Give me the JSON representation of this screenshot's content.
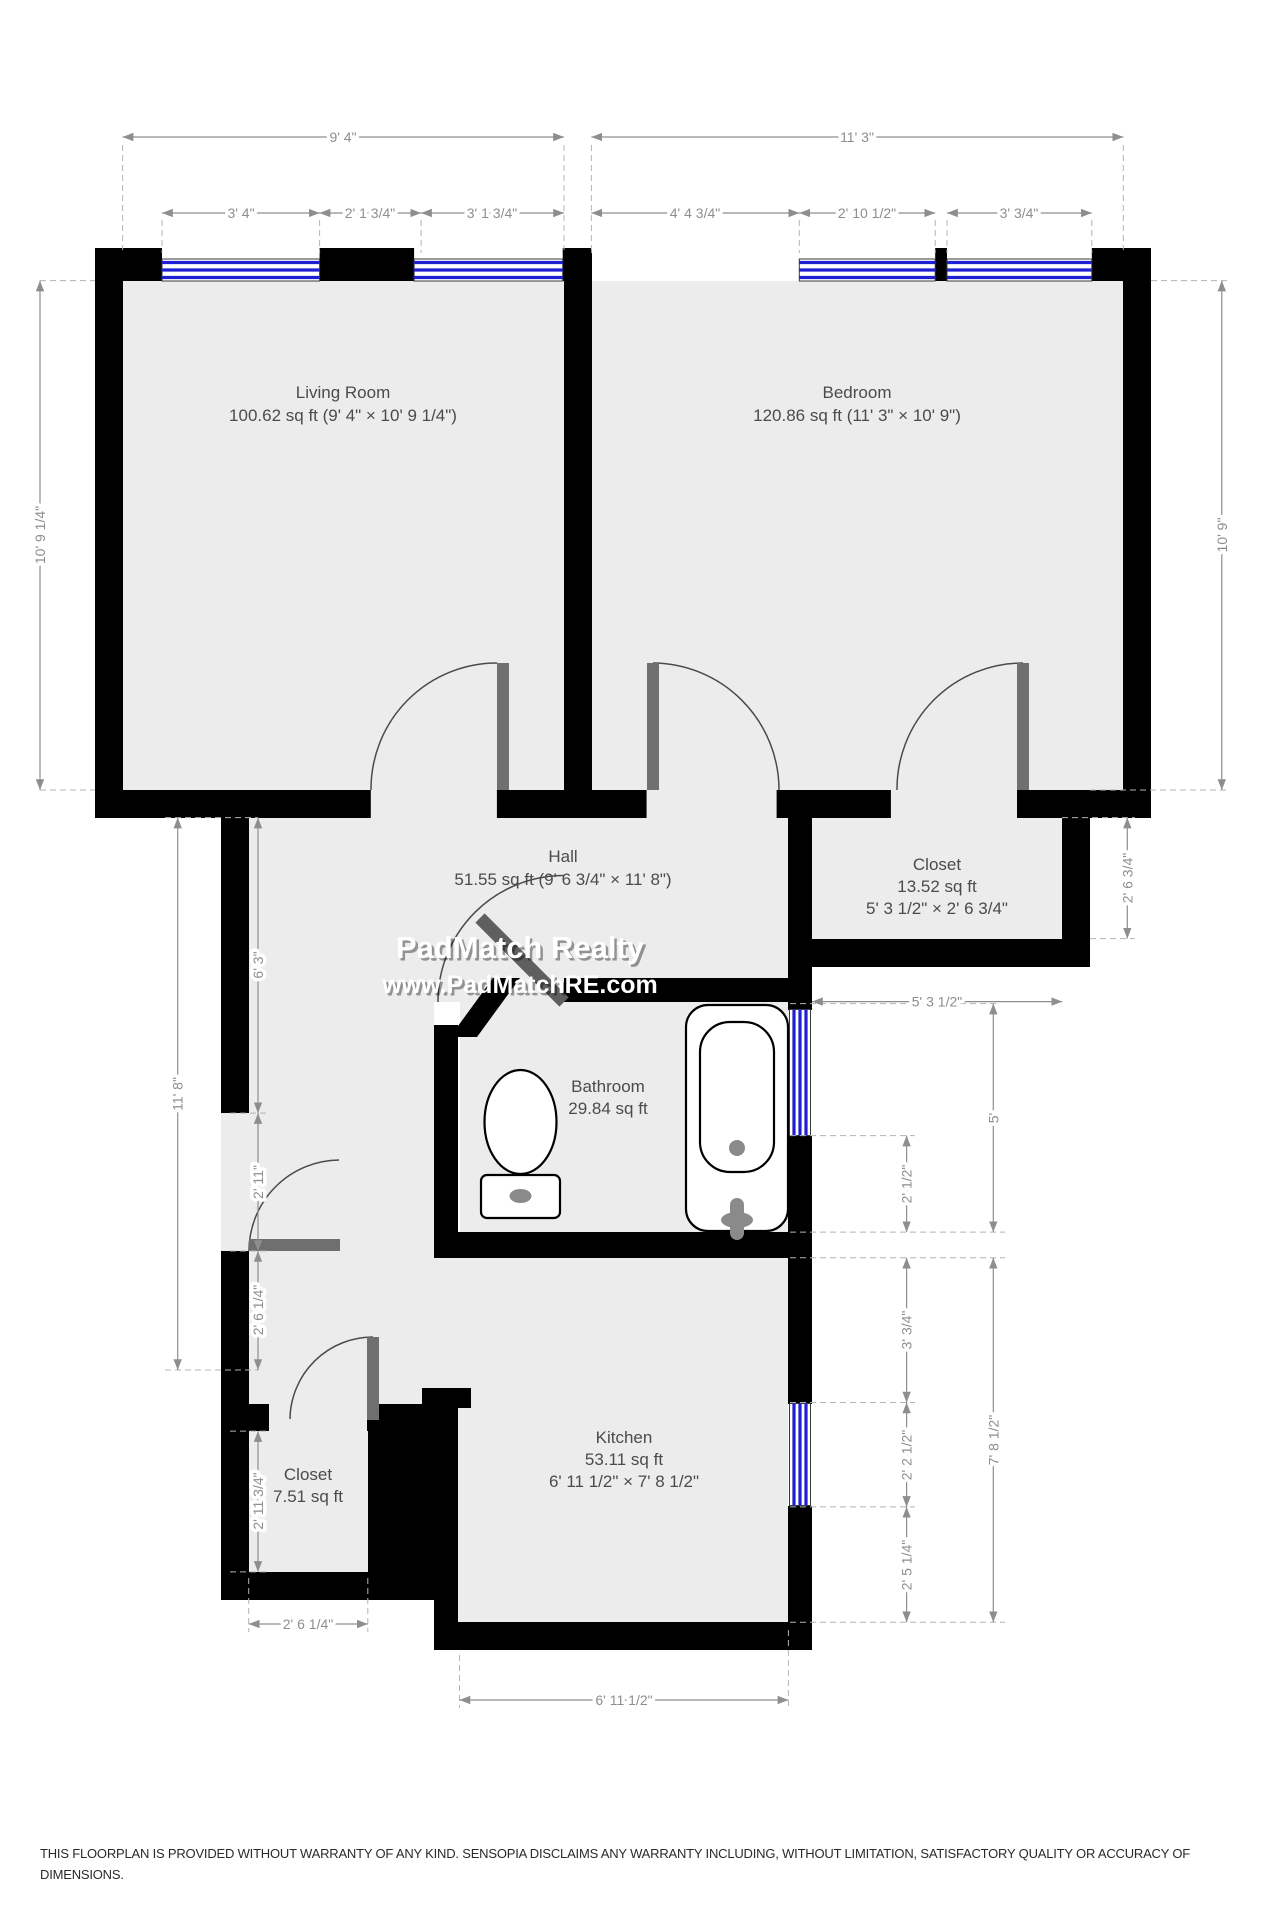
{
  "watermark": {
    "line1": "PadMatch Realty",
    "line2": "www.PadMatchRE.com"
  },
  "disclaimer": {
    "line1": "THIS FLOORPLAN IS PROVIDED WITHOUT WARRANTY OF ANY KIND. SENSOPIA DISCLAIMS ANY WARRANTY INCLUDING, WITHOUT LIMITATION, SATISFACTORY QUALITY OR ACCURACY OF",
    "line2": "DIMENSIONS."
  },
  "rooms": {
    "living": {
      "name": "Living Room",
      "area": "100.62 sq ft (9' 4\" × 10' 9 1/4\")"
    },
    "bedroom": {
      "name": "Bedroom",
      "area": "120.86 sq ft (11' 3\" × 10' 9\")"
    },
    "hall": {
      "name": "Hall",
      "area": "51.55 sq ft (9' 6 3/4\" × 11' 8\")"
    },
    "closet_top": {
      "name": "Closet",
      "area": "13.52 sq ft",
      "dims": "5' 3 1/2\" × 2' 6 3/4\""
    },
    "bathroom": {
      "name": "Bathroom",
      "area": "29.84 sq ft"
    },
    "kitchen": {
      "name": "Kitchen",
      "area": "53.11 sq ft",
      "dims": "6' 11 1/2\" × 7' 8 1/2\""
    },
    "closet_bottom": {
      "name": "Closet",
      "area": "7.51 sq ft"
    }
  },
  "dimensions": {
    "top_living_total": "9' 4\"",
    "top_living_1": "3' 4\"",
    "top_living_2": "2' 1 3/4\"",
    "top_living_3": "3' 1 3/4\"",
    "top_bedroom_total": "11' 3\"",
    "top_bedroom_1": "4' 4 3/4\"",
    "top_bedroom_2": "2' 10 1/2\"",
    "top_bedroom_3": "3' 3/4\"",
    "left_living": "10' 9 1/4\"",
    "right_bedroom": "10' 9\"",
    "left_hall_total": "11' 8\"",
    "left_hall_1": "6' 3\"",
    "left_hall_2": "2' 11\"",
    "left_hall_3": "2' 6 1/4\"",
    "left_closet": "2' 11 3/4\"",
    "right_closet": "2' 6 3/4\"",
    "right_bath_width": "5' 3 1/2\"",
    "right_bath_1": "5'",
    "right_bath_2": "2' 1/2\"",
    "right_kitchen_1": "3' 3/4\"",
    "right_kitchen_2": "2' 2 1/2\"",
    "right_kitchen_3": "2' 5 1/4\"",
    "right_kitchen_total": "7' 8 1/2\"",
    "bottom_closet": "2' 6 1/4\"",
    "bottom_kitchen": "6' 11 1/2\""
  },
  "colors": {
    "floor": "#ececec",
    "wall": "#000000",
    "door": "#6f6f6f",
    "window_blue": "#1f1fd4",
    "dim": "#8e8e8e",
    "label": "#4b4b4b"
  }
}
